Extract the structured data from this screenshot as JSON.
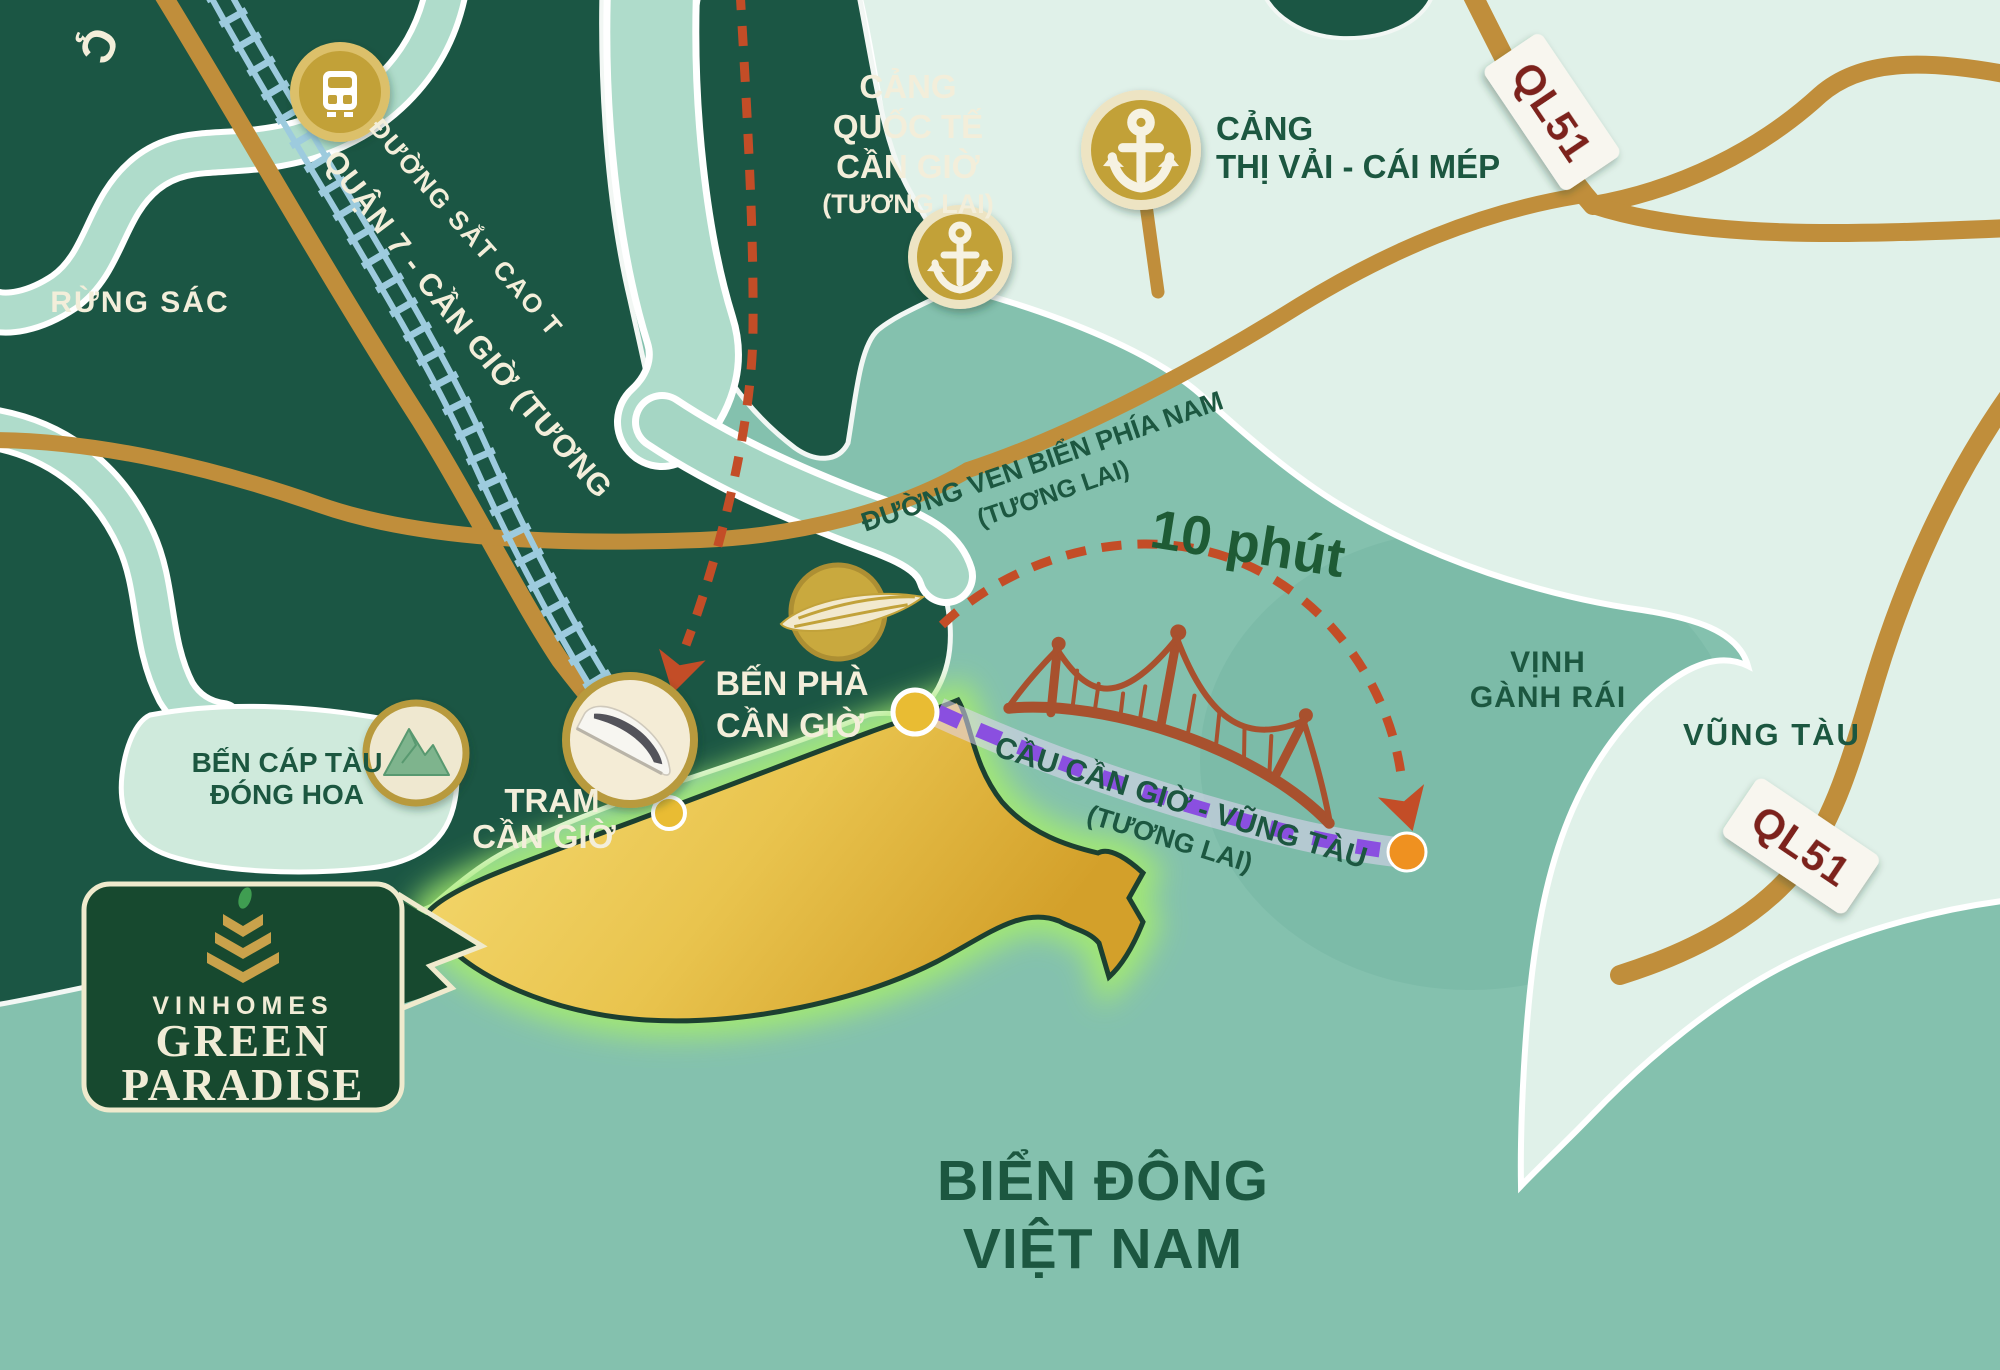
{
  "map_title": "Vinhomes Green Paradise location map",
  "corner_fragment": "Ç",
  "areas": {
    "rung_sac": "RỪNG SÁC",
    "vinh_ganh_rai": [
      "VỊNH",
      "GÀNH RÁI"
    ],
    "vung_tau": "VŨNG TÀU",
    "bien_dong": [
      "BIỂN ĐÔNG",
      "VIỆT NAM"
    ]
  },
  "routes": {
    "railway_label": [
      "ĐƯỜNG SẮT CAO TỐC",
      "QUẬN 7 - CẦN GIỜ (TƯƠNG LAI)"
    ],
    "coastal_road": [
      "ĐƯỜNG VEN BIỂN PHÍA NAM",
      "(TƯƠNG LAI)"
    ],
    "bridge_time": "10 phút",
    "bridge_name": [
      "CẦU CẦN GIỜ - VŨNG TÀU",
      "(TƯƠNG LAI)"
    ],
    "highway_badge": "QL51"
  },
  "places": {
    "cang_quoc_te": [
      "CẢNG",
      "QUỐC TẾ",
      "CẦN GIỜ",
      "(TƯƠNG LAI)"
    ],
    "cang_thi_vai": [
      "CẢNG",
      "THỊ VẢI - CÁI MÉP"
    ],
    "ben_pha": [
      "BẾN PHÀ",
      "CẦN GIỜ"
    ],
    "tram": [
      "TRẠM",
      "CẦN GIỜ"
    ],
    "ben_cap_tau": [
      "BẾN CÁP TÀU",
      "ĐÓNG HOA"
    ]
  },
  "logo": {
    "brand": "VINHOMES",
    "name_line1": "GREEN",
    "name_line2": "PARADISE"
  },
  "icons": [
    "train-icon",
    "anchor-icon",
    "ferry-icon",
    "bullet-train-icon",
    "mountain-icon",
    "bridge-icon",
    "lotus-icon"
  ],
  "colors": {
    "sea": "#84C1AE",
    "bay": "#74B3A1",
    "land_mint": "#E0F1E9",
    "land_dark": "#1B5644",
    "river": "#AFDCCB",
    "mint_patch": "#CFEADC",
    "road_gold": "#C08E3B",
    "railway_blue": "#9DCBDE",
    "route_red": "#C34D27",
    "route_purple": "#8A4FE0",
    "island_gold": "#E3B73E",
    "glow_green": "#A5EC6E",
    "dot_yellow": "#E9BC33",
    "dot_orange": "#EF9120",
    "icon_gold": "#C2A138",
    "icon_ring_pale": "#EDE4C3",
    "text_cream": "#F3EEDA",
    "text_dark_green": "#1C5740",
    "ql51_red": "#7D241B",
    "plate_white": "#F8F6EF",
    "bridge_rust": "#A8512E",
    "logo_bg": "#17492F",
    "logo_border": "#EFEACD"
  }
}
